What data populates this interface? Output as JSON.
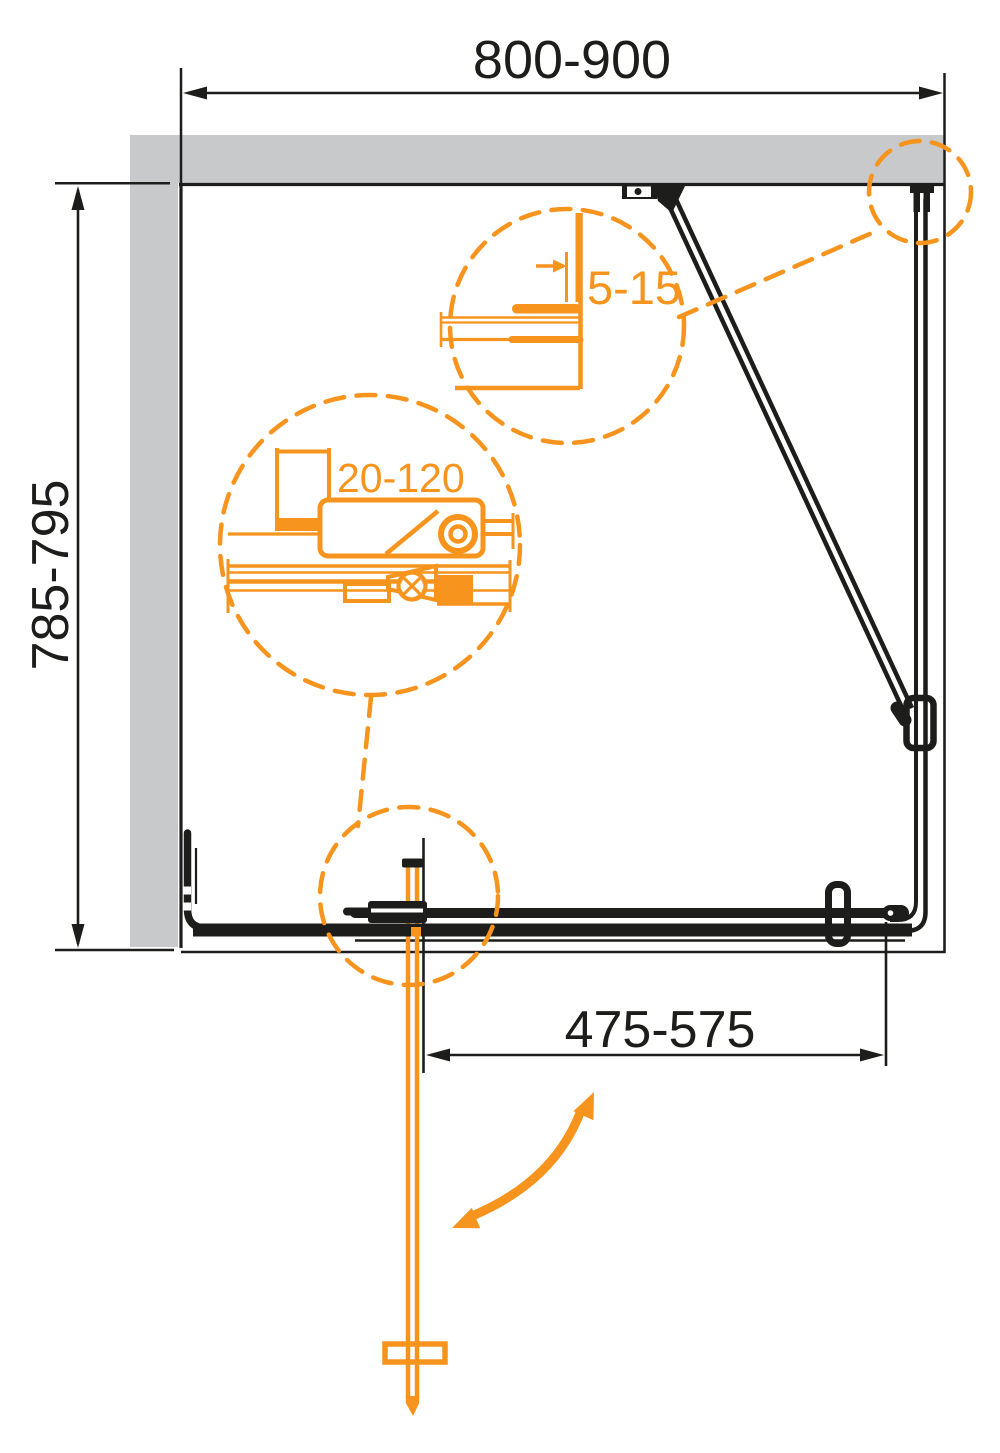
{
  "labels": {
    "overall_width": "800-900",
    "overall_depth": "785-795",
    "door_width": "475-575",
    "wall_profile_adjustment": "5-15",
    "extension_adjustment": "20-120"
  },
  "colors": {
    "accent": "#F7941E",
    "wall": "#C8C9CB",
    "line": "#1D1D1B",
    "background": "#FFFFFF"
  }
}
